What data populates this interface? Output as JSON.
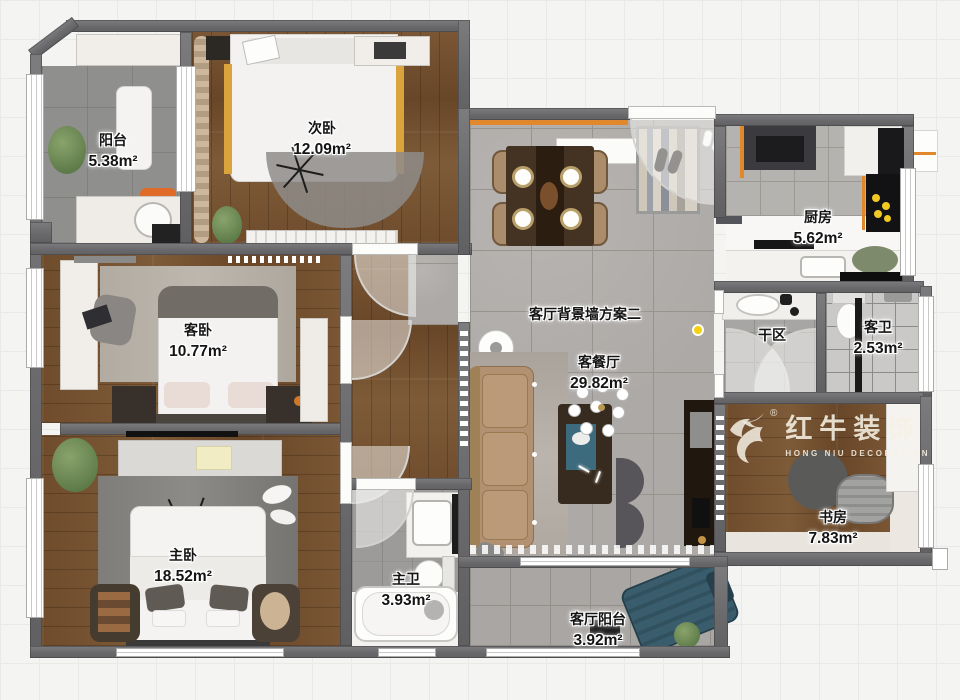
{
  "rooms": [
    {
      "name": "阳台",
      "area": "5.38m²"
    },
    {
      "name": "次卧",
      "area": "12.09m²"
    },
    {
      "name": "客卧",
      "area": "10.77m²"
    },
    {
      "name": "主卧",
      "area": "18.52m²"
    },
    {
      "name": "主卫",
      "area": "3.93m²"
    },
    {
      "name": "客餐厅",
      "area": "29.82m²"
    },
    {
      "name": "客厅阳台",
      "area": "3.92m²"
    },
    {
      "name": "厨房",
      "area": "5.62m²"
    },
    {
      "name": "干区",
      "area": ""
    },
    {
      "name": "客卫",
      "area": "2.53m²"
    },
    {
      "name": "书房",
      "area": "7.83m²"
    }
  ],
  "annotation": {
    "wall_plan_note": "客厅背景墙方案二"
  },
  "watermark": {
    "brand": "红牛装饰",
    "subtitle": "HONG NIU DECORATION",
    "registered": "®"
  },
  "palette": {
    "wall_gray": "#6C6C6E",
    "wood_floor": "#74502F",
    "living_tile": "#ACA9A6",
    "balcony_tile": "#8F8F8D",
    "accent_orange": "#E0882B",
    "sofa_tan": "#B29172",
    "lounge_teal": "#3A5D6E",
    "flame_yellow": "#F2C822",
    "marker_yellow": "#F4D00E",
    "background": "#F4F4F2"
  }
}
